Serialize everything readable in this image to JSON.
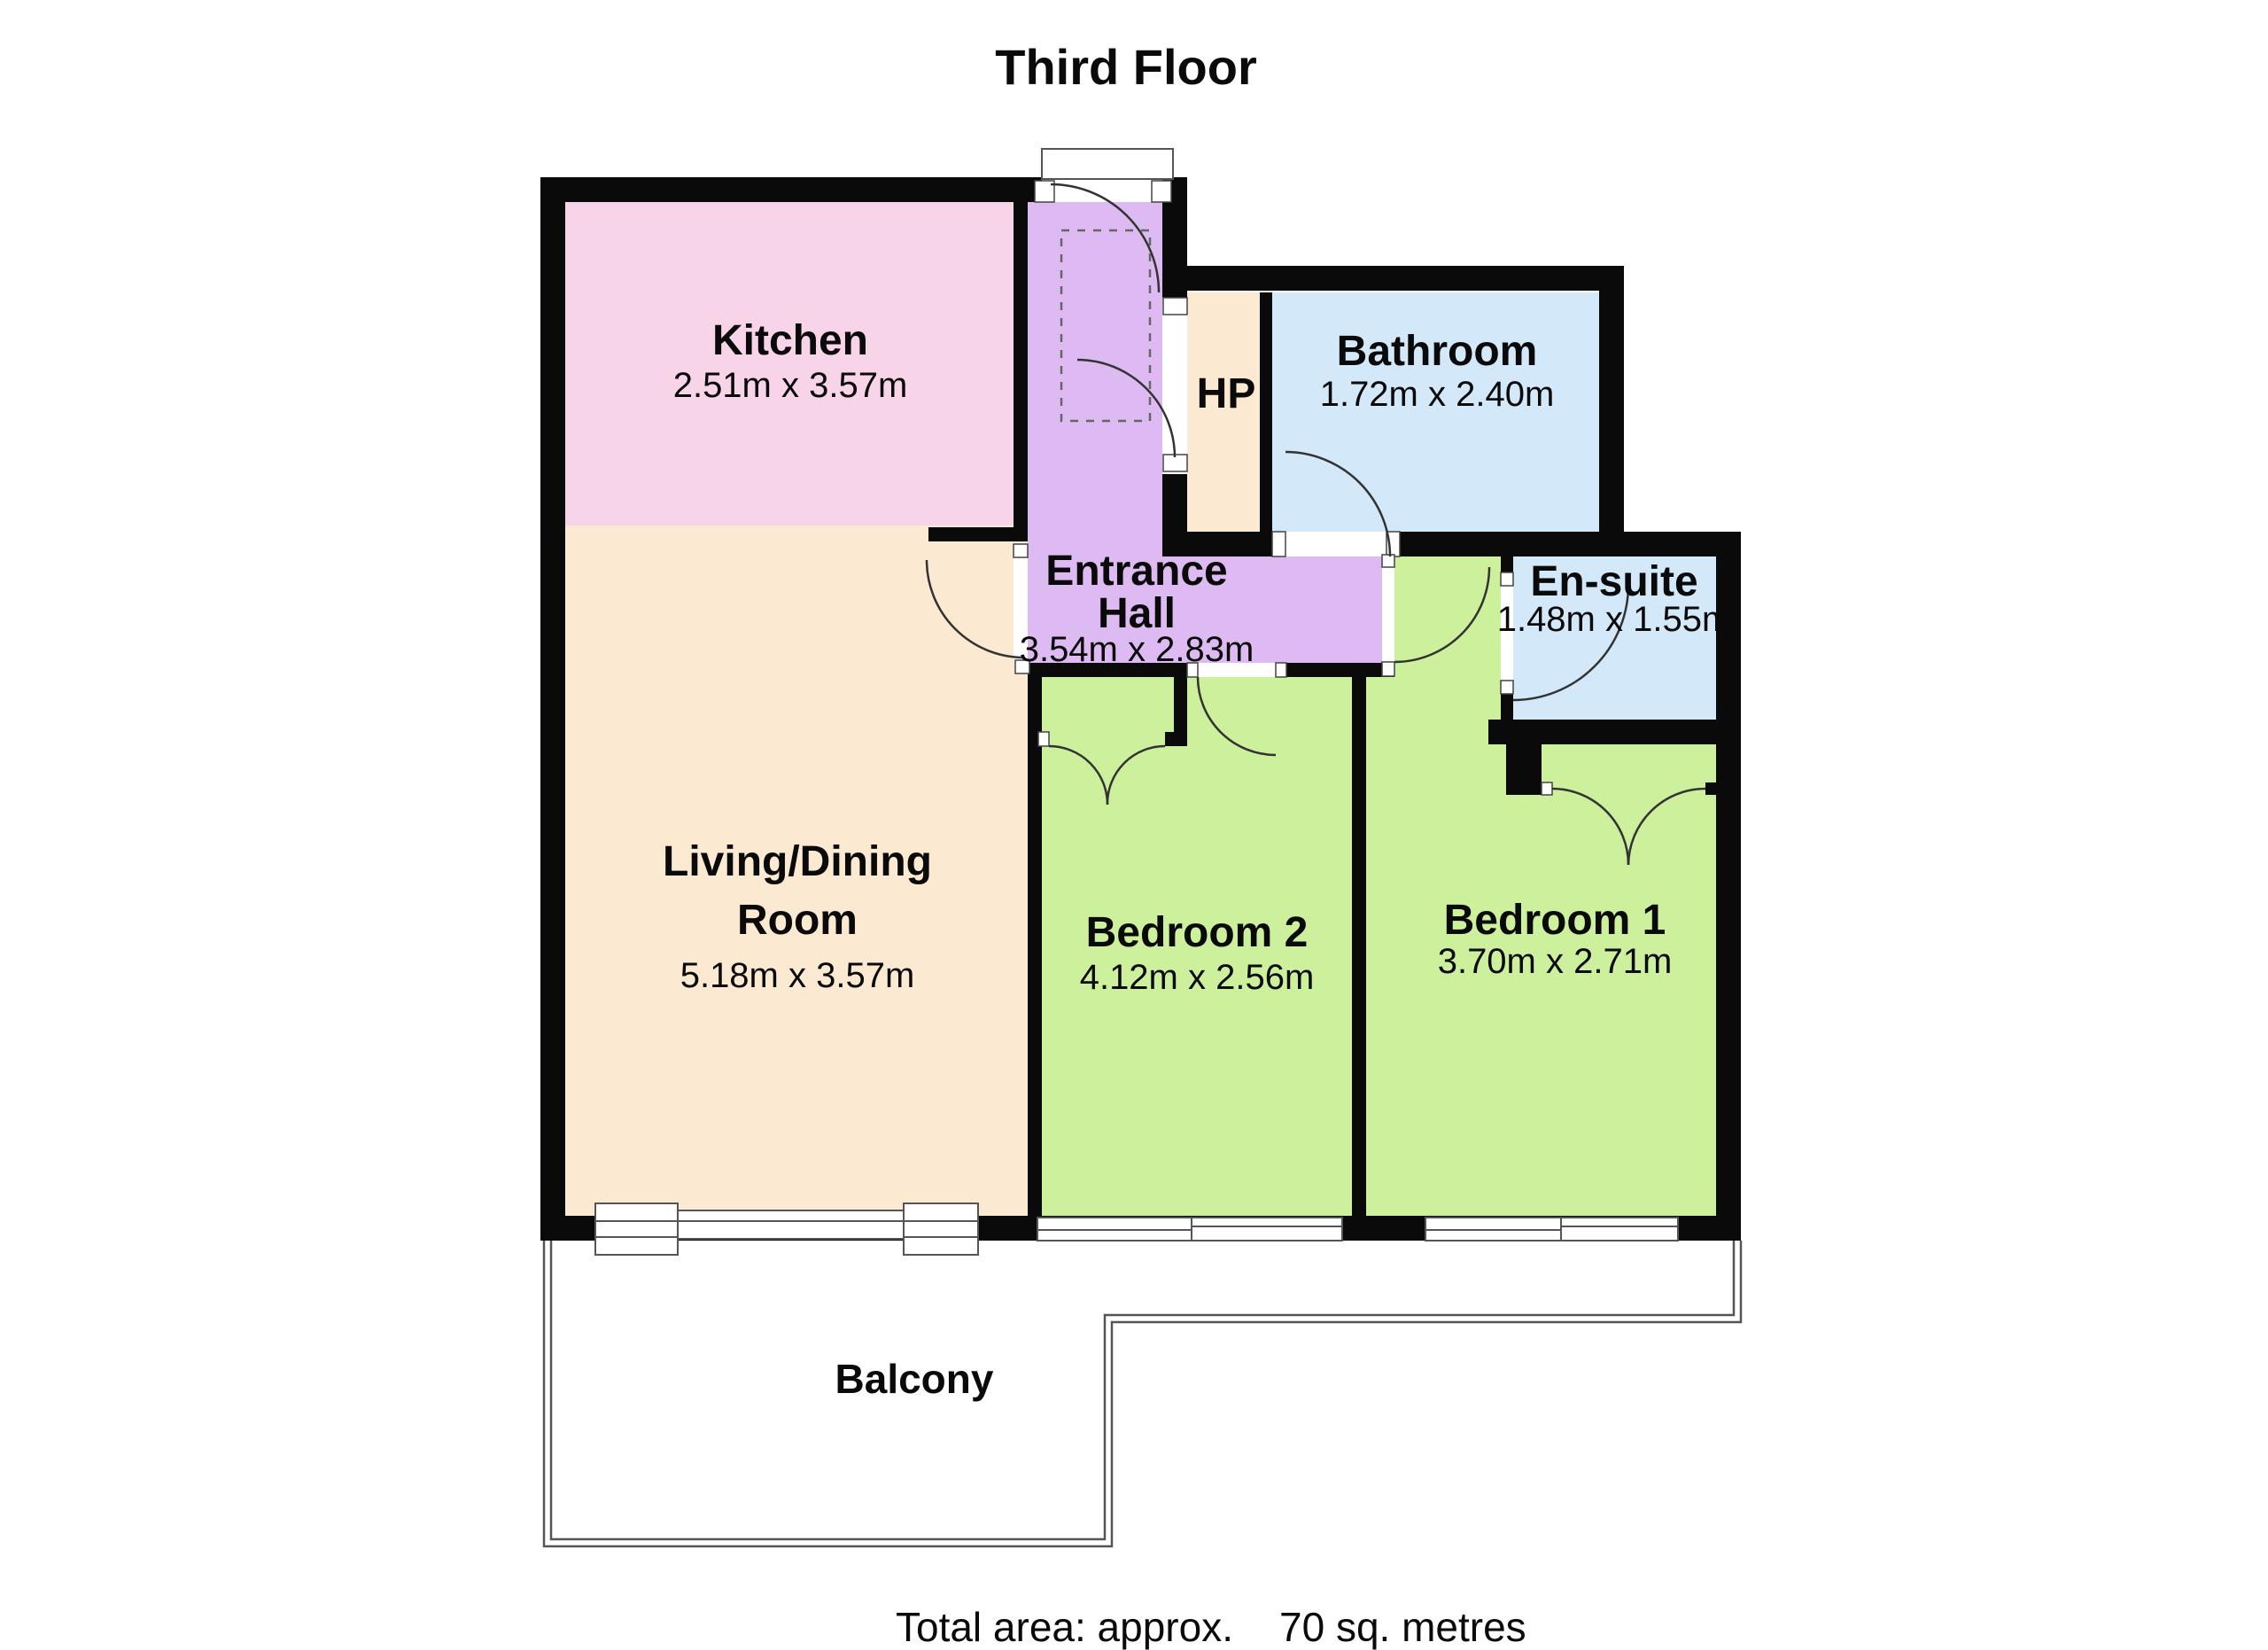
{
  "title": "Third Floor",
  "rooms": {
    "kitchen": {
      "name": "Kitchen",
      "dims": "2.51m x 3.57m"
    },
    "bathroom": {
      "name": "Bathroom",
      "dims": "1.72m x 2.40m"
    },
    "hp": {
      "name": "HP"
    },
    "entrance_hall": {
      "name_line1": "Entrance",
      "name_line2": "Hall",
      "dims": "3.54m x 2.83m"
    },
    "ensuite": {
      "name": "En-suite",
      "dims": "1.48m x 1.55m"
    },
    "living_dining": {
      "name_line1": "Living/Dining",
      "name_line2": "Room",
      "dims": "5.18m x 3.57m"
    },
    "bedroom2": {
      "name": "Bedroom 2",
      "dims": "4.12m x 2.56m"
    },
    "bedroom1": {
      "name": "Bedroom 1",
      "dims": "3.70m x 2.71m"
    },
    "balcony": {
      "name": "Balcony"
    }
  },
  "footer": {
    "label": "Total area: approx.",
    "value": "70 sq. metres"
  },
  "colors": {
    "wall": "#0a0a0a",
    "kitchen": "#f8d4e8",
    "cream": "#fbead1",
    "hall": "#ddbbf2",
    "bath": "#d3e8f9",
    "bedroom": "#cdf09c",
    "outline": "#555555"
  }
}
